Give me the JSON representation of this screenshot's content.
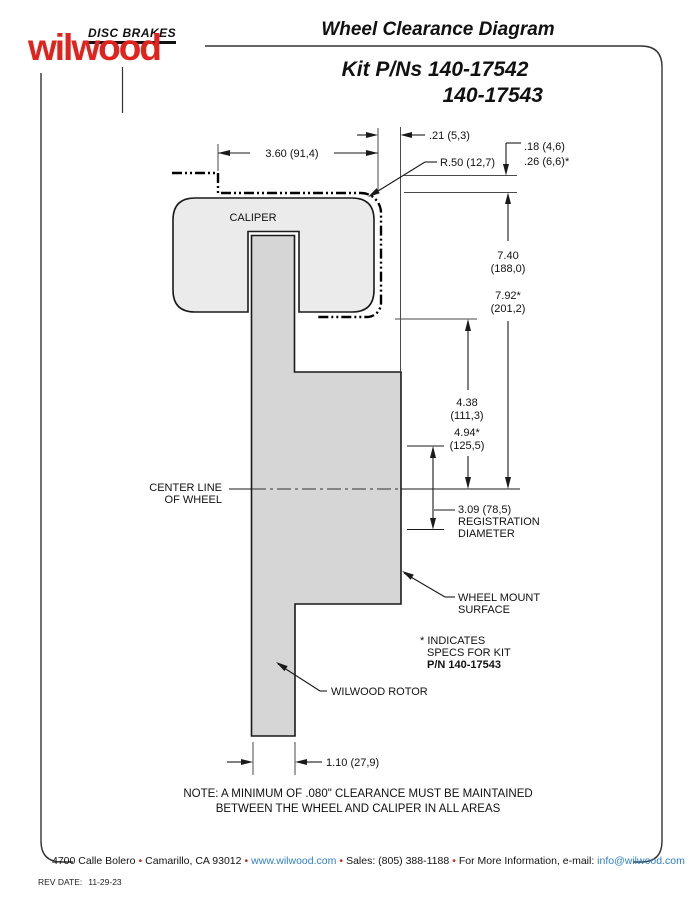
{
  "header": {
    "brand_top": "DISC BRAKES",
    "brand_name": "wilwood",
    "title": "Wheel Clearance Diagram",
    "kit_line1": "Kit P/Ns 140-17542",
    "kit_line2": "140-17543"
  },
  "diagram": {
    "labels": {
      "caliper": "CALIPER",
      "centerline": [
        "CENTER LINE",
        "OF WHEEL"
      ],
      "wheel_mount": [
        "WHEEL MOUNT",
        "SURFACE"
      ],
      "spec_note": [
        "* INDICATES",
        "SPECS FOR KIT",
        "P/N 140-17543"
      ],
      "rotor": "WILWOOD ROTOR"
    },
    "dims": {
      "w360": "3.60 (91,4)",
      "w21": ".21 (5,3)",
      "r50": "R.50 (12,7)",
      "g18": ".18 (4,6)",
      "g26": ".26 (6,6)*",
      "h740": [
        "7.40",
        "(188,0)"
      ],
      "h792": [
        "7.92*",
        "(201,2)"
      ],
      "h438": [
        "4.38",
        "(111,3)"
      ],
      "h494": [
        "4.94*",
        "(125,5)"
      ],
      "reg": [
        "3.09 (78,5)",
        "REGISTRATION",
        "DIAMETER"
      ],
      "w110": "1.10 (27,9)"
    },
    "note_line1": "NOTE: A MINIMUM OF .080\" CLEARANCE MUST BE MAINTAINED",
    "note_line2": "BETWEEN THE WHEEL AND CALIPER IN ALL AREAS"
  },
  "footer": {
    "address": "4700 Calle Bolero",
    "city": "Camarillo, CA 93012",
    "web": "www.wilwood.com",
    "sales": "Sales: (805) 388-1188",
    "info_label": "For More Information, e-mail:",
    "email": "info@wilwood.com",
    "bullet": "•",
    "rev_label": "REV DATE:",
    "rev_value": "11-29-23"
  },
  "colors": {
    "brand_red": "#e0231c",
    "link_blue": "#2f80c9",
    "bullet_red": "#cc2a1f",
    "caliper_fill": "#ebebeb",
    "rotor_fill": "#d6d6d6",
    "line_black": "#1a1a1a"
  }
}
